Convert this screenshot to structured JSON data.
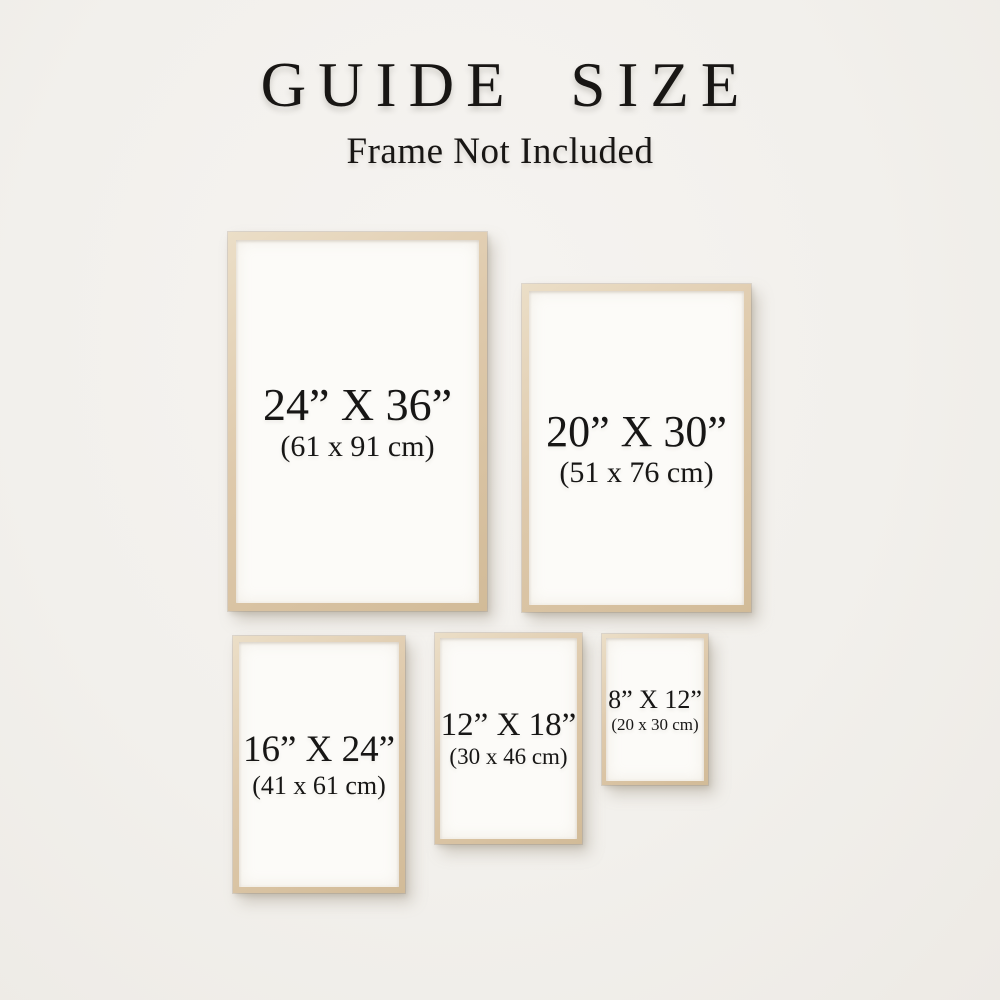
{
  "header": {
    "title": "GUIDE SIZE",
    "subtitle": "Frame Not Included"
  },
  "frames": [
    {
      "name": "24x36",
      "inches": "24” X 36”",
      "cm": "(61 x 91 cm)"
    },
    {
      "name": "20x30",
      "inches": "20” X 30”",
      "cm": "(51 x 76 cm)"
    },
    {
      "name": "16x24",
      "inches": "16” X 24”",
      "cm": "(41 x 61 cm)"
    },
    {
      "name": "12x18",
      "inches": "12” X 18”",
      "cm": "(30 x 46 cm)"
    },
    {
      "name": "8x12",
      "inches": "8” X 12”",
      "cm": "(20 x 30 cm)"
    }
  ],
  "colors": {
    "background": "#f2f0ec",
    "wood_light": "#ebdec7",
    "wood_dark": "#d2bb98",
    "paper": "#fcfbf8",
    "text": "#171615"
  }
}
